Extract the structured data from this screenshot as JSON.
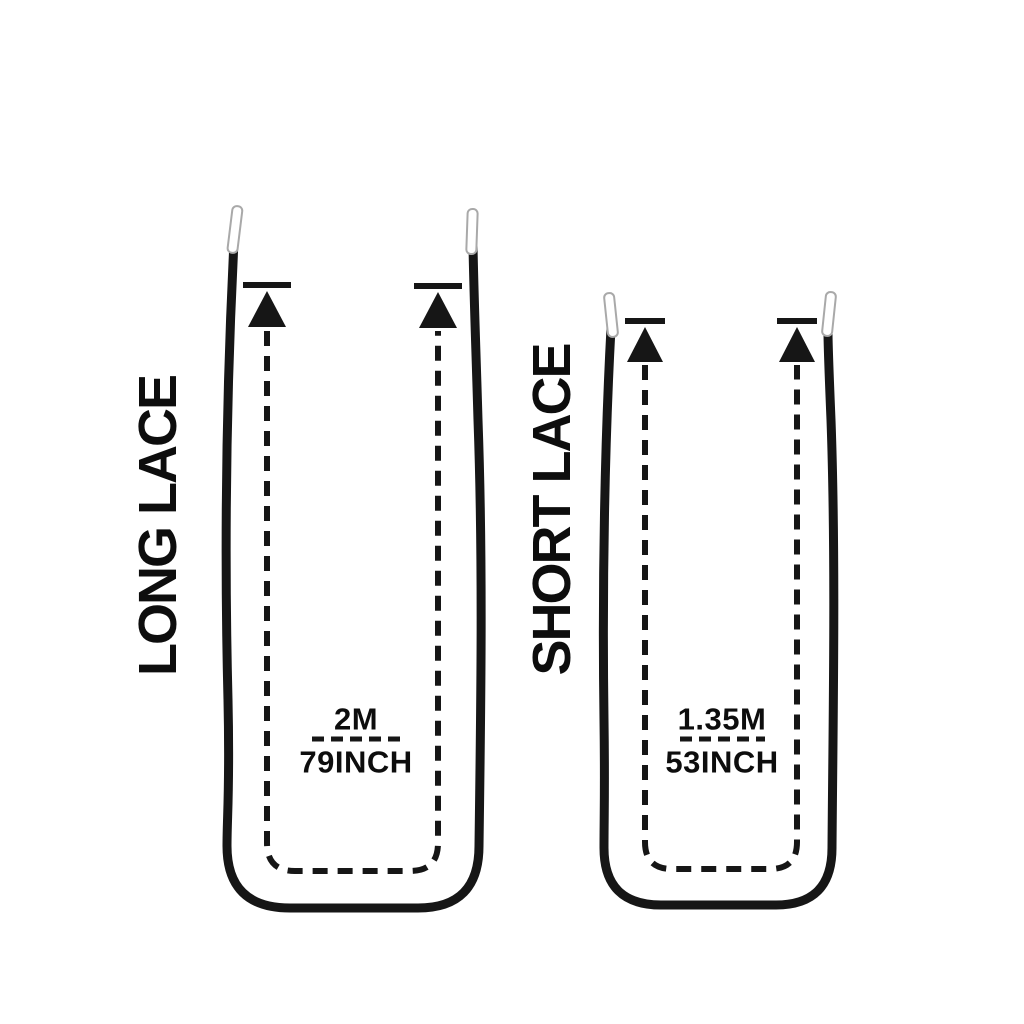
{
  "page": {
    "background_color": "#ffffff",
    "line_color": "#161616",
    "text_color": "#0d0d0d",
    "aglet_fill": "#ffffff",
    "aglet_stroke_color": "#a9a9a9"
  },
  "diagram": {
    "type": "shoelace-length-comparison",
    "laces": [
      {
        "id": "long",
        "label": "LONG LACE",
        "length_meters": "2M",
        "length_inches": "79INCH"
      },
      {
        "id": "short",
        "label": "SHORT LACE",
        "length_meters": "1.35M",
        "length_inches": "53INCH"
      }
    ]
  }
}
